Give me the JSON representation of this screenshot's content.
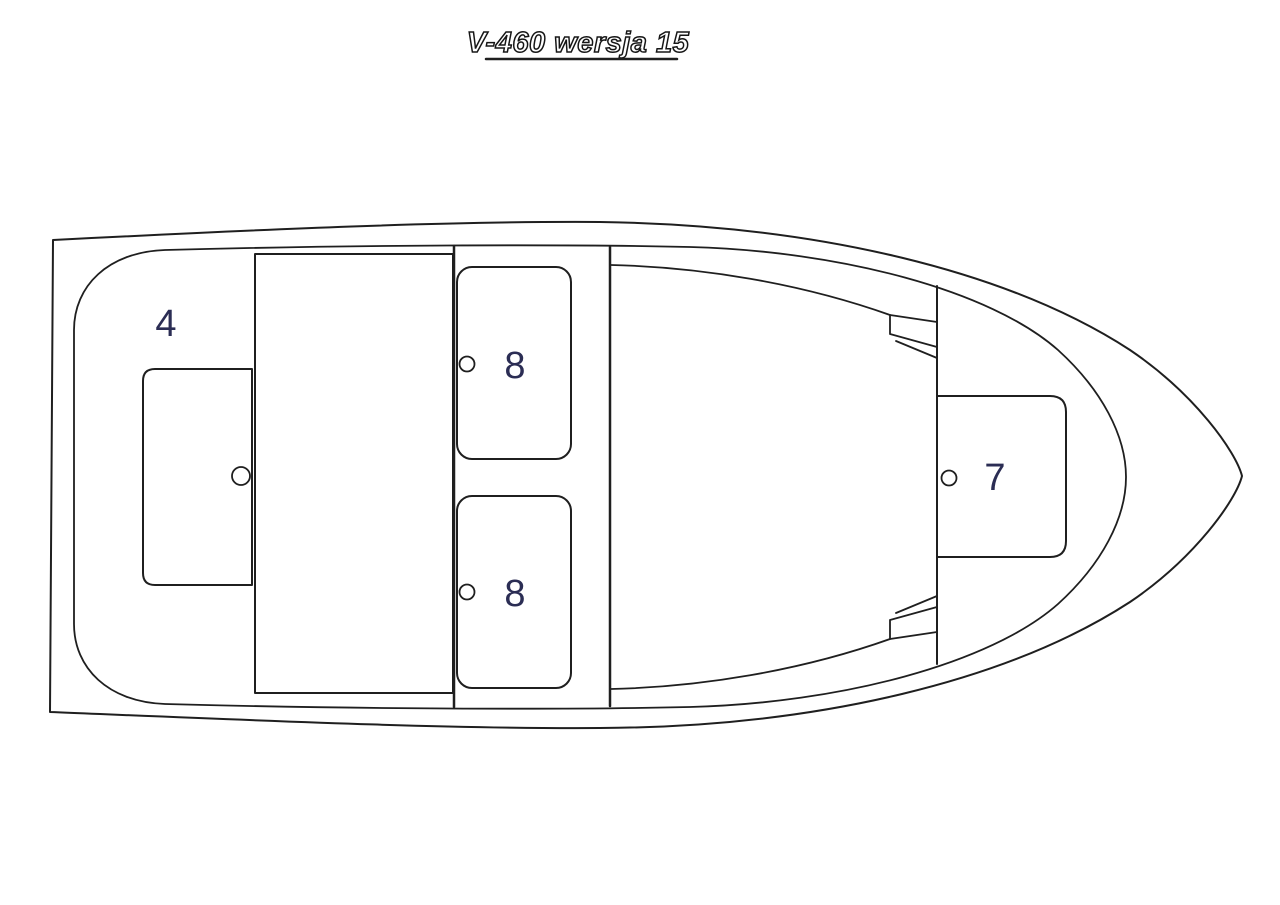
{
  "title": {
    "text": "V-460 wersja 15"
  },
  "colors": {
    "background": "#ffffff",
    "line": "#1f1f1f",
    "label": "#2b2d54",
    "title_fill": "#ffffff",
    "title_outline": "#161616"
  },
  "diagram": {
    "type": "boat-deck-plan-top-view",
    "orientation": "bow-right",
    "labels": [
      {
        "area": "stern-storage-compartment",
        "text": "4"
      },
      {
        "area": "midship-seat-top",
        "text": "8"
      },
      {
        "area": "midship-seat-bottom",
        "text": "8"
      },
      {
        "area": "bow-seat",
        "text": "7"
      }
    ]
  }
}
